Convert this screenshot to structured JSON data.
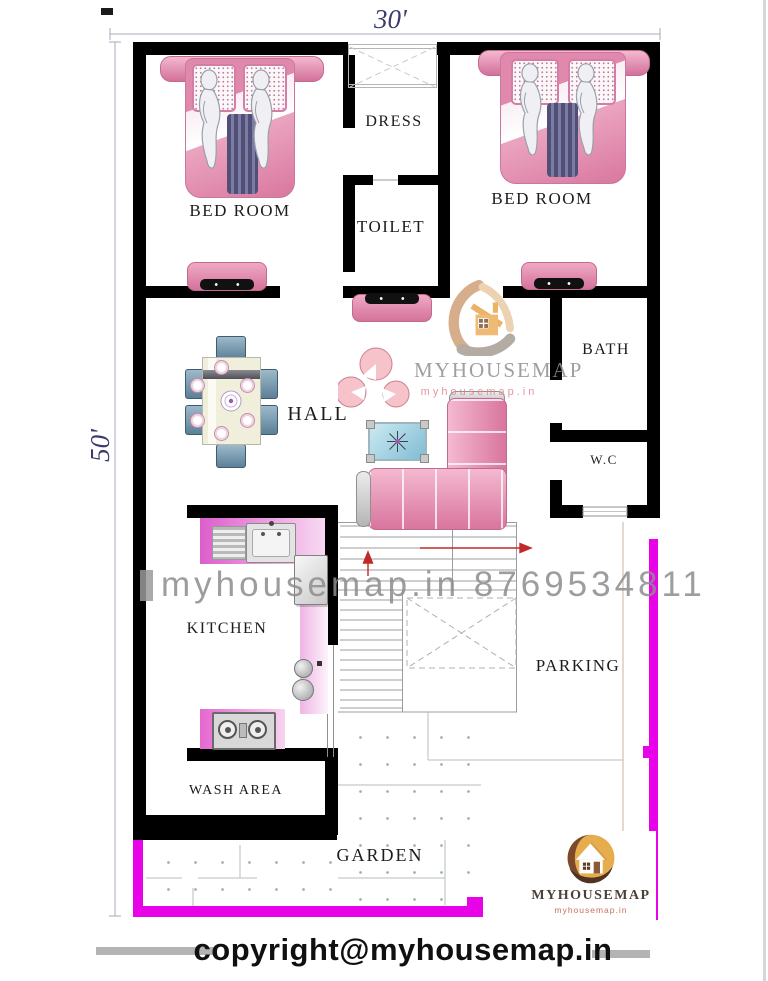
{
  "plan": {
    "dim_width": "30'",
    "dim_height": "50'"
  },
  "rooms": {
    "bedroom_left": "BED ROOM",
    "dress": "DRESS",
    "toilet": "TOILET",
    "bedroom_right": "BED ROOM",
    "hall": "HALL",
    "bath": "BATH",
    "wc": "W.C",
    "kitchen": "KITCHEN",
    "wash_area": "WASH AREA",
    "garden": "GARDEN",
    "parking": "PARKING"
  },
  "watermark": {
    "brand": "MYHOUSEMAP",
    "site": "myhousemap.in",
    "diagonal": "myhousemap.in 8769534811"
  },
  "footer": {
    "brand": "MYHOUSEMAP",
    "site": "myhousemap.in",
    "copyright": "copyright@myhousemap.in"
  },
  "colors": {
    "wall": "#000000",
    "compound": "#e802e8",
    "furniture_pink": "#e289ad",
    "counter_magenta": "#dd5ecb",
    "dimension_text": "#3b3c6e",
    "watermark_gray": "#8d8d8d",
    "logo_gold": "#e6ad4f",
    "logo_brown": "#7c4a2b"
  }
}
